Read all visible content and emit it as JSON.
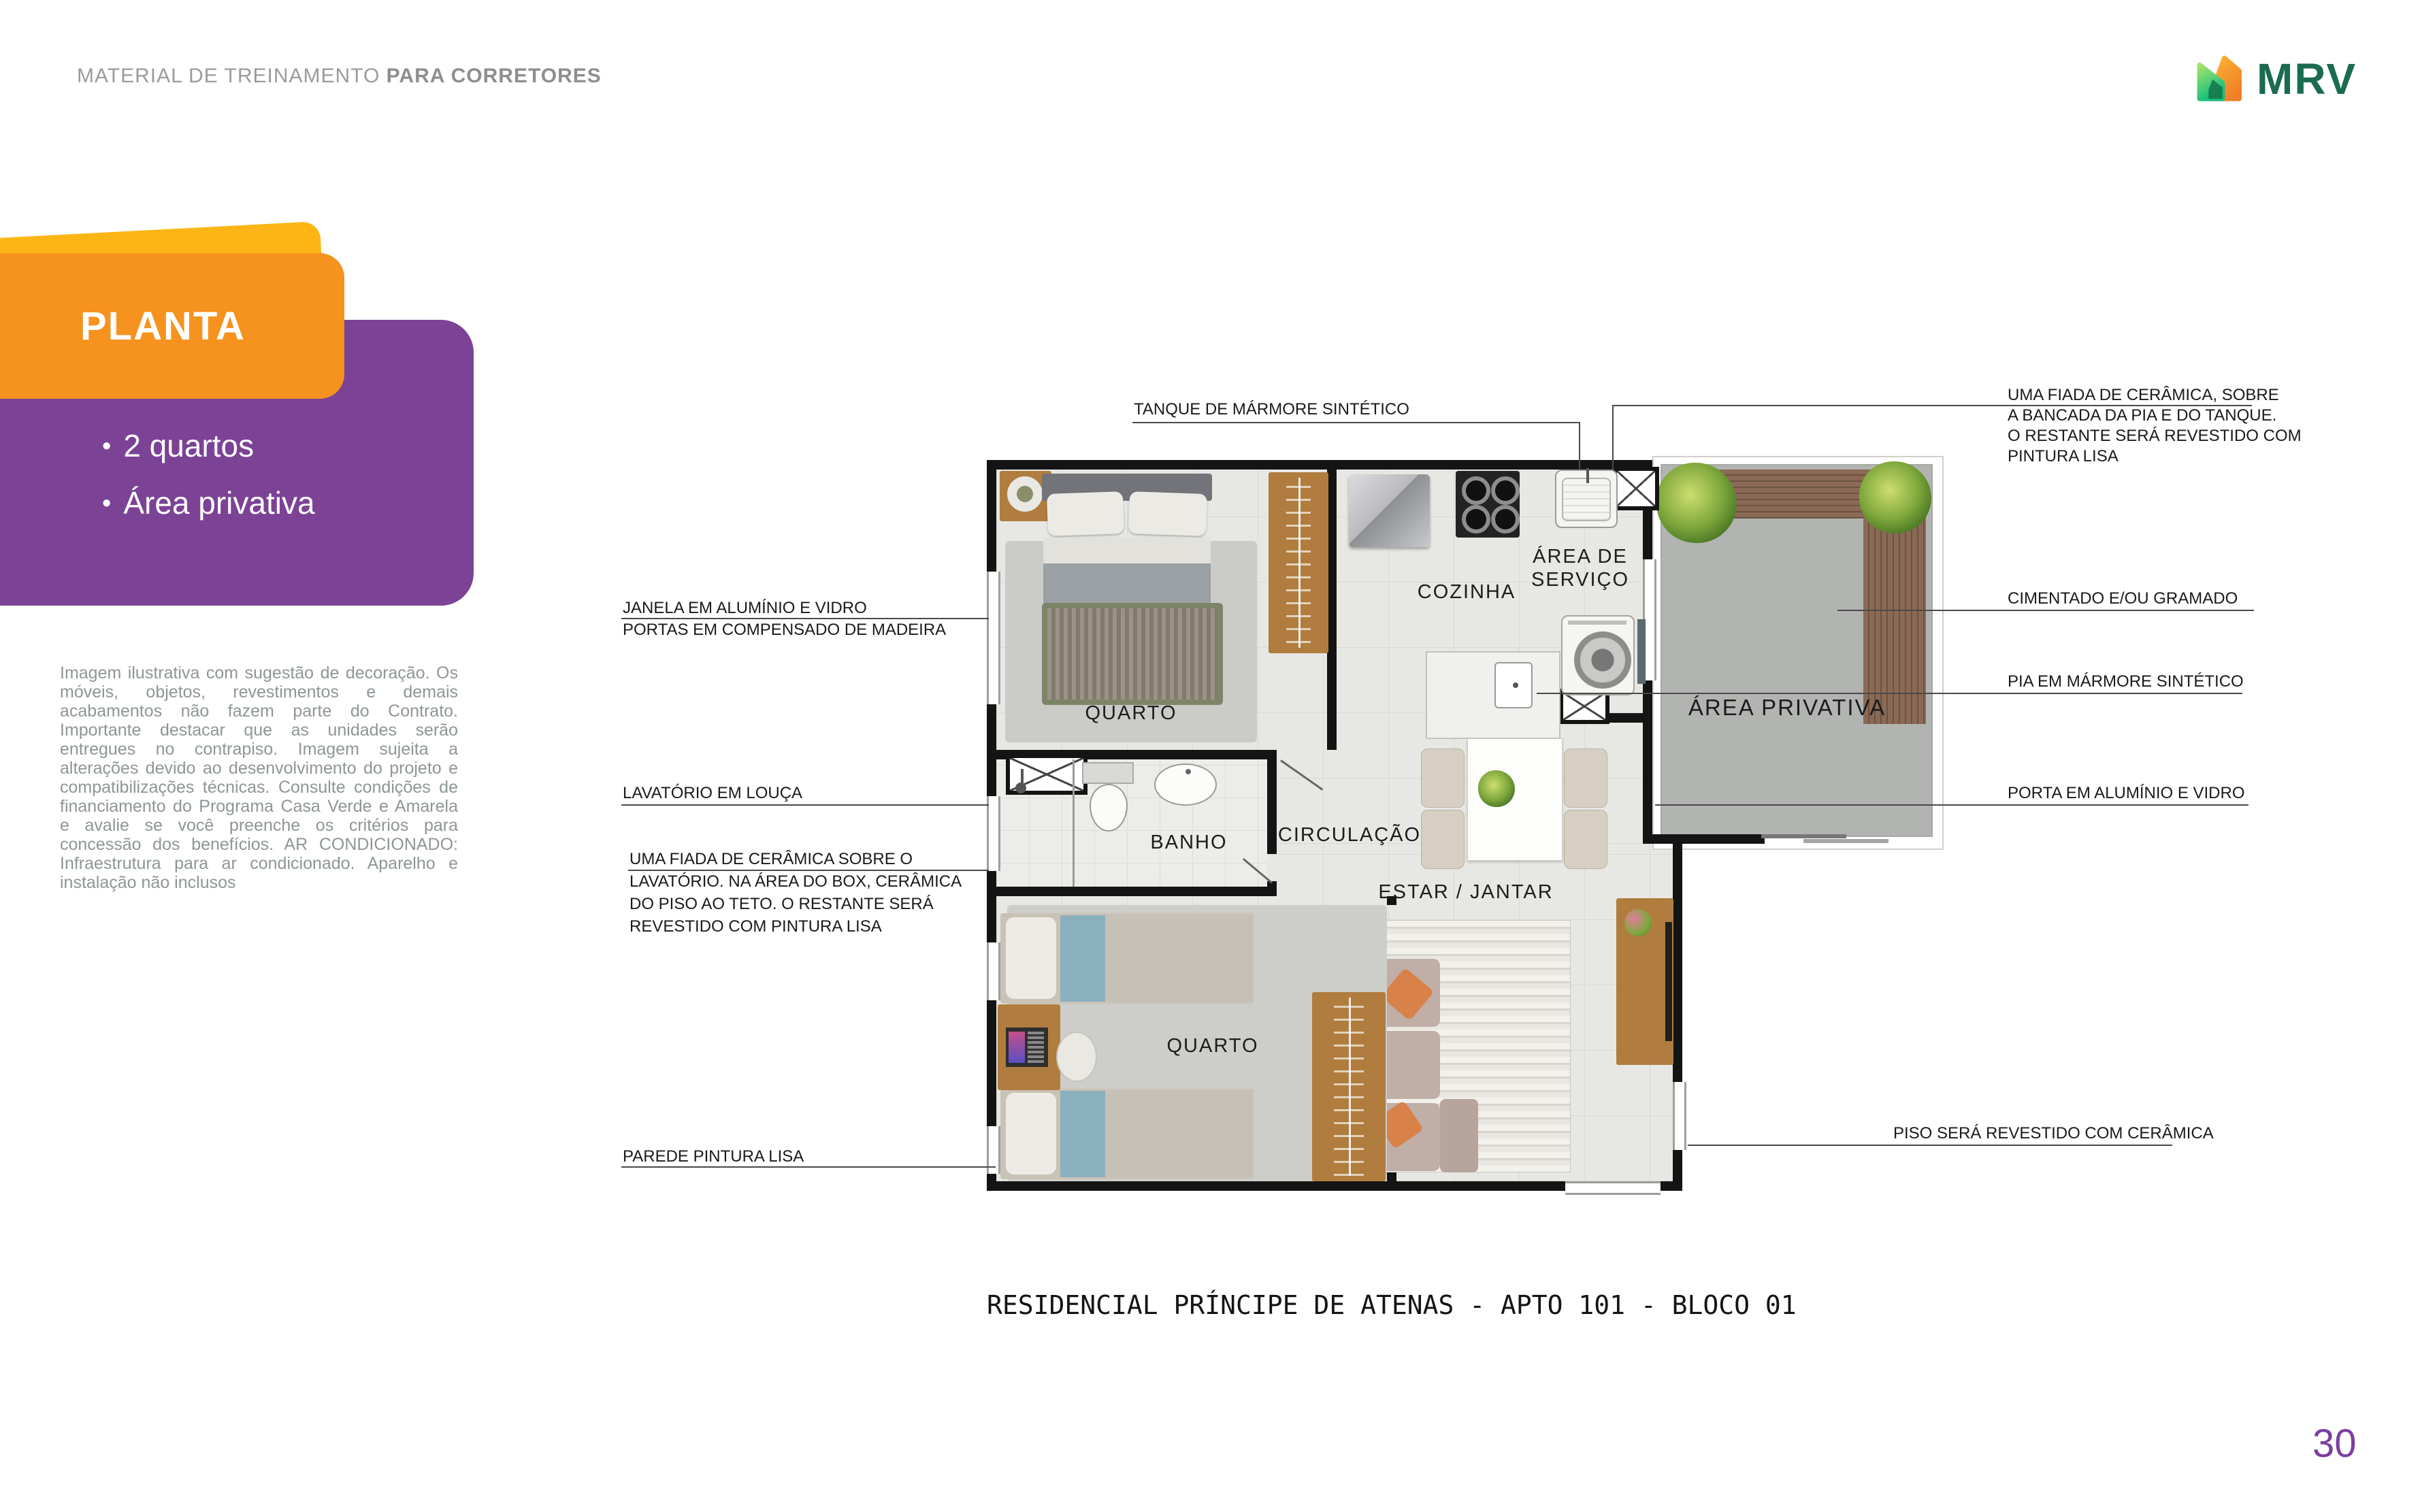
{
  "header": {
    "title_regular": "MATERIAL DE TREINAMENTO ",
    "title_bold": "PARA CORRETORES"
  },
  "logo": {
    "brand": "MRV"
  },
  "panel": {
    "tab": "PLANTA",
    "bullet_char": "•",
    "bullets": [
      "2 quartos",
      "Área privativa"
    ]
  },
  "disclaimer": "Imagem ilustrativa com sugestão de decoração. Os móveis, objetos, revestimentos e demais acabamentos não fazem parte do Contrato. Importante destacar que as unidades serão entregues no contrapiso. Imagem sujeita a alterações devido ao desenvolvimento do projeto e compatibilizações técnicas. Consulte condições de financiamento do Programa Casa Verde e Amarela e avalie se você preenche os critérios para concessão dos benefícios. AR CONDICIONADO: Infraestrutura para ar condicionado. Aparelho e instalação não inclusos",
  "floorplan": {
    "rooms": {
      "bedroom1": "QUARTO",
      "kitchen": "COZINHA",
      "service_line1": "ÁREA DE",
      "service_line2": "SERVIÇO",
      "private_area": "ÁREA PRIVATIVA",
      "hallway": "CIRCULAÇÃO",
      "bathroom": "BANHO",
      "living": "ESTAR / JANTAR",
      "bedroom2": "QUARTO"
    },
    "annotations": {
      "tanque": "TANQUE DE MÁRMORE SINTÉTICO",
      "fiada_right": [
        "UMA FIADA DE CERÂMICA, SOBRE",
        "A BANCADA DA PIA E DO TANQUE.",
        "O RESTANTE SERÁ REVESTIDO COM",
        "PINTURA LISA"
      ],
      "cimentado": "CIMENTADO E/OU GRAMADO",
      "pia": "PIA EM MÁRMORE SINTÉTICO",
      "porta": "PORTA EM ALUMÍNIO E VIDRO",
      "piso": "PISO SERÁ REVESTIDO COM CERÂMICA",
      "janela": "JANELA EM ALUMÍNIO E VIDRO",
      "portas": "PORTAS EM COMPENSADO DE MADEIRA",
      "lavatorio": "LAVATÓRIO EM LOUÇA",
      "fiada_left": [
        "UMA FIADA DE CERÂMICA SOBRE O",
        "LAVATÓRIO. NA ÁREA DO BOX, CERÂMICA",
        "DO PISO AO TETO. O RESTANTE SERÁ",
        "REVESTIDO COM PINTURA LISA"
      ],
      "parede": "PAREDE PINTURA LISA"
    },
    "caption": "RESIDENCIAL PRÍNCIPE DE ATENAS - APTO 101 - BLOCO 01"
  },
  "page_number": "30",
  "colors": {
    "orange": "#F6921E",
    "yellow": "#FBB616",
    "purple": "#7B4296",
    "logo-green": "#1A6B4F",
    "header-gray": "#9B9B9B",
    "disclaimer-gray": "#8E9792",
    "page-purple": "#7B3FA0",
    "wall": "#141414",
    "tile": "#E7E8E4",
    "patio": "#B2B4B1",
    "wood": "#B07D3E",
    "deck": "#8B6A55"
  }
}
